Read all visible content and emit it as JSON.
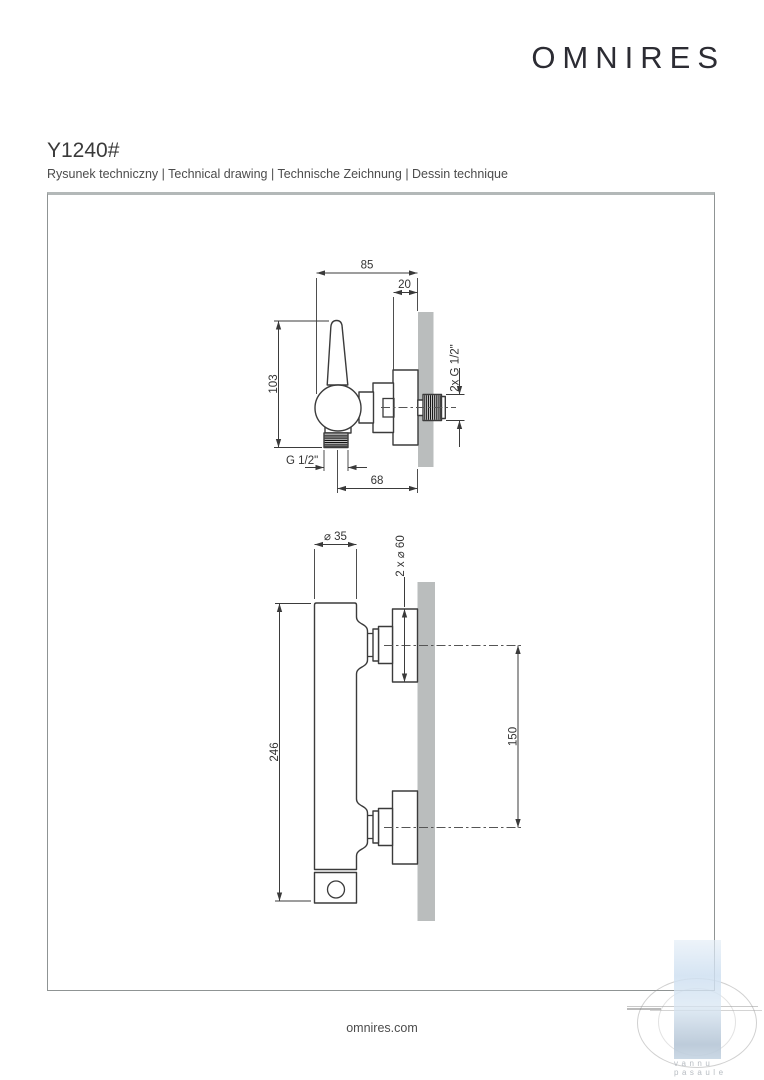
{
  "header": {
    "logo": "OMNIRES"
  },
  "product": {
    "code": "Y1240#",
    "subtitle": "Rysunek techniczny | Technical drawing | Technische Zeichnung | Dessin technique"
  },
  "drawing1": {
    "name": "side view of shower mixer",
    "dim_width": "85",
    "dim_wall_offset": "20",
    "dim_height": "103",
    "label_outlet_thread": "G 1/2\"",
    "dim_depth": "68",
    "label_wall_thread": "2x G 1/2\""
  },
  "drawing2": {
    "name": "front view of shower mixer",
    "dim_body_diameter": "⌀ 35",
    "label_rosette_diameter": "2 x ⌀ 60",
    "dim_total_height": "246",
    "dim_connection_spacing": "150"
  },
  "footer": {
    "website": "omnires.com"
  },
  "watermark": {
    "line1": "vannu",
    "line2": "pasaule"
  },
  "colors": {
    "line": "#3b3b3b",
    "wall_gray": "#babdbd",
    "watermark_blue": "#cfe0f1",
    "watermark_gray": "#b7bcc2"
  }
}
